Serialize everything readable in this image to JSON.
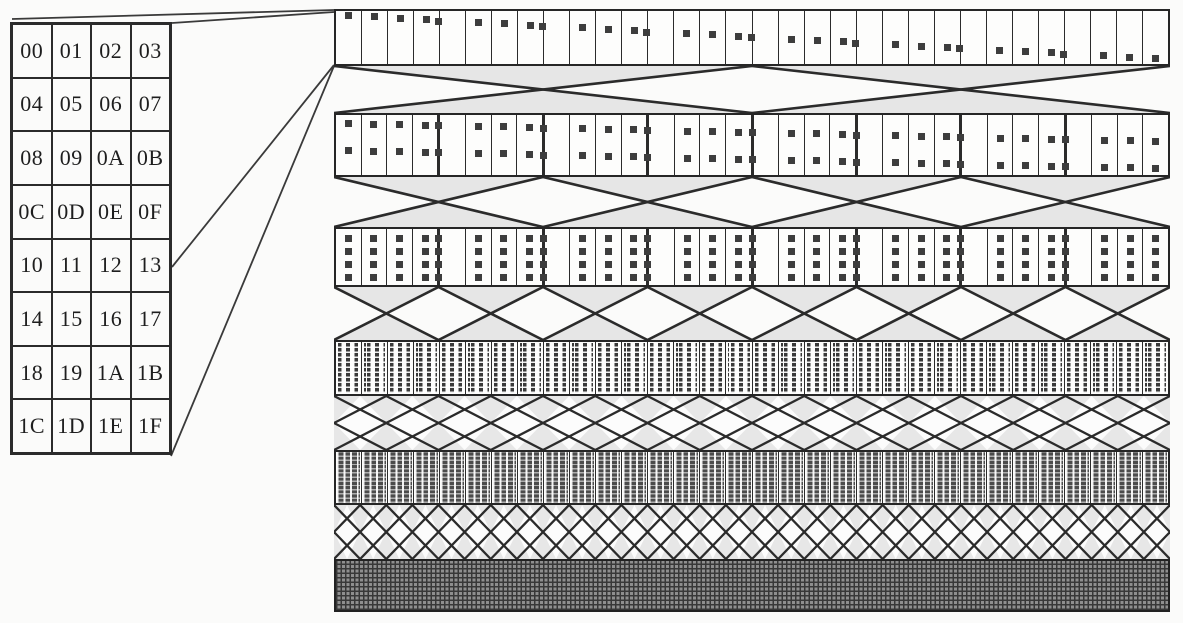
{
  "memory_table": {
    "columns": 4,
    "rows": [
      [
        "00",
        "01",
        "02",
        "03"
      ],
      [
        "04",
        "05",
        "06",
        "07"
      ],
      [
        "08",
        "09",
        "0A",
        "0B"
      ],
      [
        "0C",
        "0D",
        "0E",
        "0F"
      ],
      [
        "10",
        "11",
        "12",
        "13"
      ],
      [
        "14",
        "15",
        "16",
        "17"
      ],
      [
        "18",
        "19",
        "1A",
        "1B"
      ],
      [
        "1C",
        "1D",
        "1E",
        "1F"
      ]
    ]
  },
  "network": {
    "num_stages": 6,
    "stages": [
      {
        "cells": 32,
        "dots_per_cell": 1,
        "style": "single-dots-descending"
      },
      {
        "cells": 32,
        "dots_per_cell": 2,
        "style": "double-dots-descending"
      },
      {
        "cells": 32,
        "dots_per_cell": 4,
        "style": "quad-dot-columns"
      },
      {
        "cells": 32,
        "dots_per_cell": 8,
        "style": "dotted-stripes"
      },
      {
        "cells": 32,
        "dots_per_cell": 16,
        "style": "dense-dotted-stripes"
      },
      {
        "cells": 1,
        "dots_per_cell": 32,
        "style": "solid-crosshatch"
      }
    ],
    "crossings": [
      {
        "x_count": 2,
        "lattice": false
      },
      {
        "x_count": 4,
        "lattice": false
      },
      {
        "x_count": 8,
        "lattice": false
      },
      {
        "x_count": 16,
        "lattice": true
      },
      {
        "x_count": 32,
        "lattice": true
      }
    ]
  },
  "colors": {
    "line": "#2b2b2b",
    "shade": "#e6e6e6",
    "dot": "#3d3d3d",
    "background": "#fbfbfa"
  }
}
